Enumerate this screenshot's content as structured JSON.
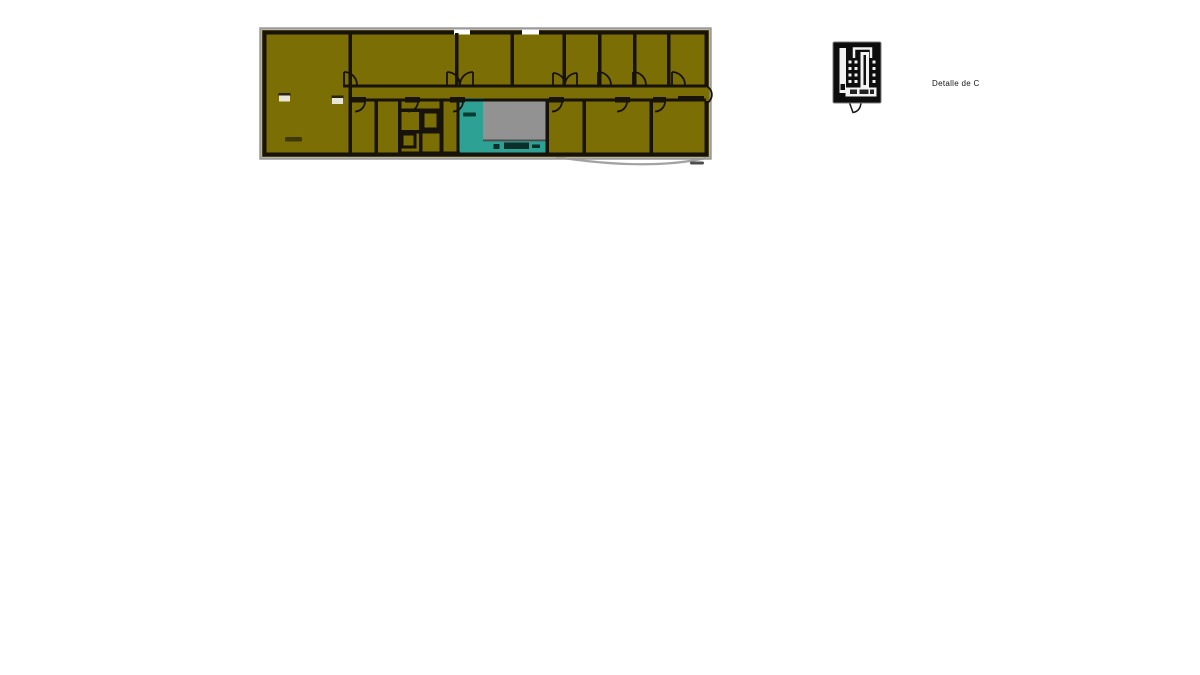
{
  "page": {
    "background_color": "#ffffff"
  },
  "floor_plan": {
    "description": "long rectangular building floor plan with central corridor, door swings, service core and stair rooms",
    "colors": {
      "room_fill": "#7a6e05",
      "wall": "#17120a",
      "frame": "#9b9b9b",
      "stair_room": "#2da294",
      "hall_room": "#929292",
      "window": "#ffffff"
    }
  },
  "detail_view": {
    "label": "Detalle de C",
    "colors": {
      "panel": "#0d0d0d",
      "linework": "#f2f2f2"
    }
  }
}
